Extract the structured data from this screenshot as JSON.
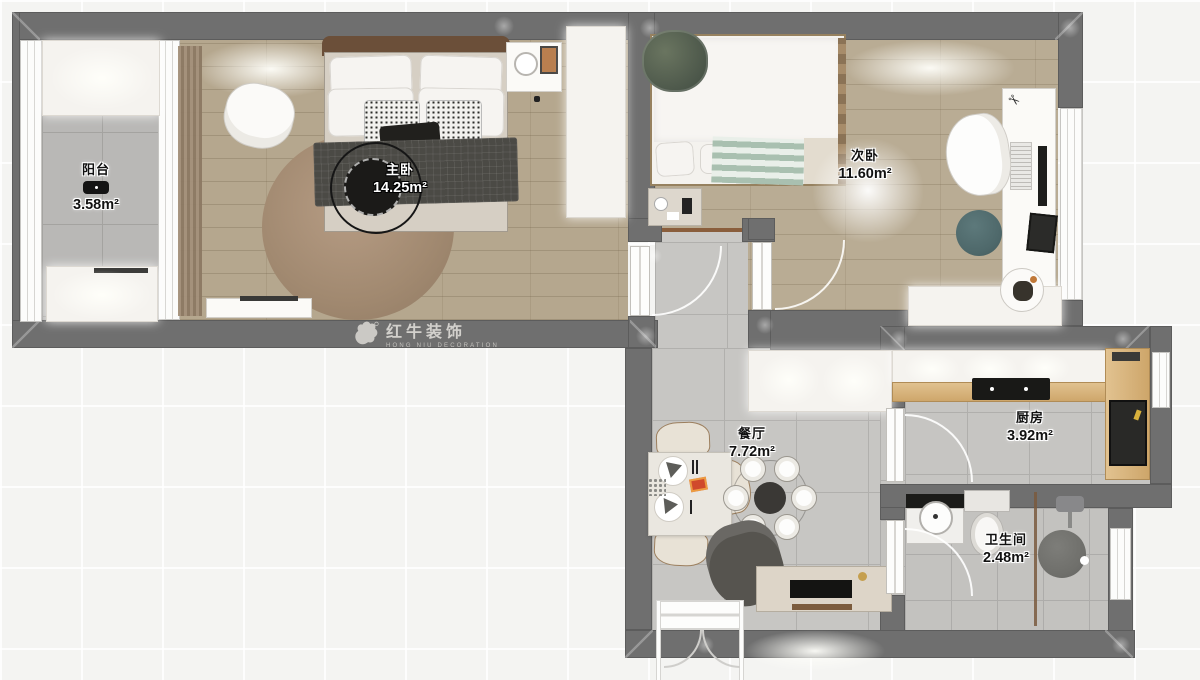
{
  "watermark": {
    "brand": "红牛装饰",
    "subtitle": "HONG NIU DECORATION"
  },
  "rooms": {
    "balcony": {
      "name": "阳台",
      "area": "3.58m²"
    },
    "master_bedroom": {
      "name": "主卧",
      "area": "14.25m²"
    },
    "second_bedroom": {
      "name": "次卧",
      "area": "11.60m²"
    },
    "dining_room": {
      "name": "餐厅",
      "area": "7.72m²"
    },
    "kitchen": {
      "name": "厨房",
      "area": "3.92m²"
    },
    "bathroom": {
      "name": "卫生间",
      "area": "2.48m²"
    }
  },
  "icons": {
    "scissors": "✂"
  },
  "colors": {
    "wall": "#6f6f6f",
    "wood_floor": "#b5a78e",
    "tile_floor": "#c7c6c3",
    "counter_wood": "#d9b988",
    "accent_teal": "#50696b",
    "watermark_text": "#d2d0cc"
  }
}
